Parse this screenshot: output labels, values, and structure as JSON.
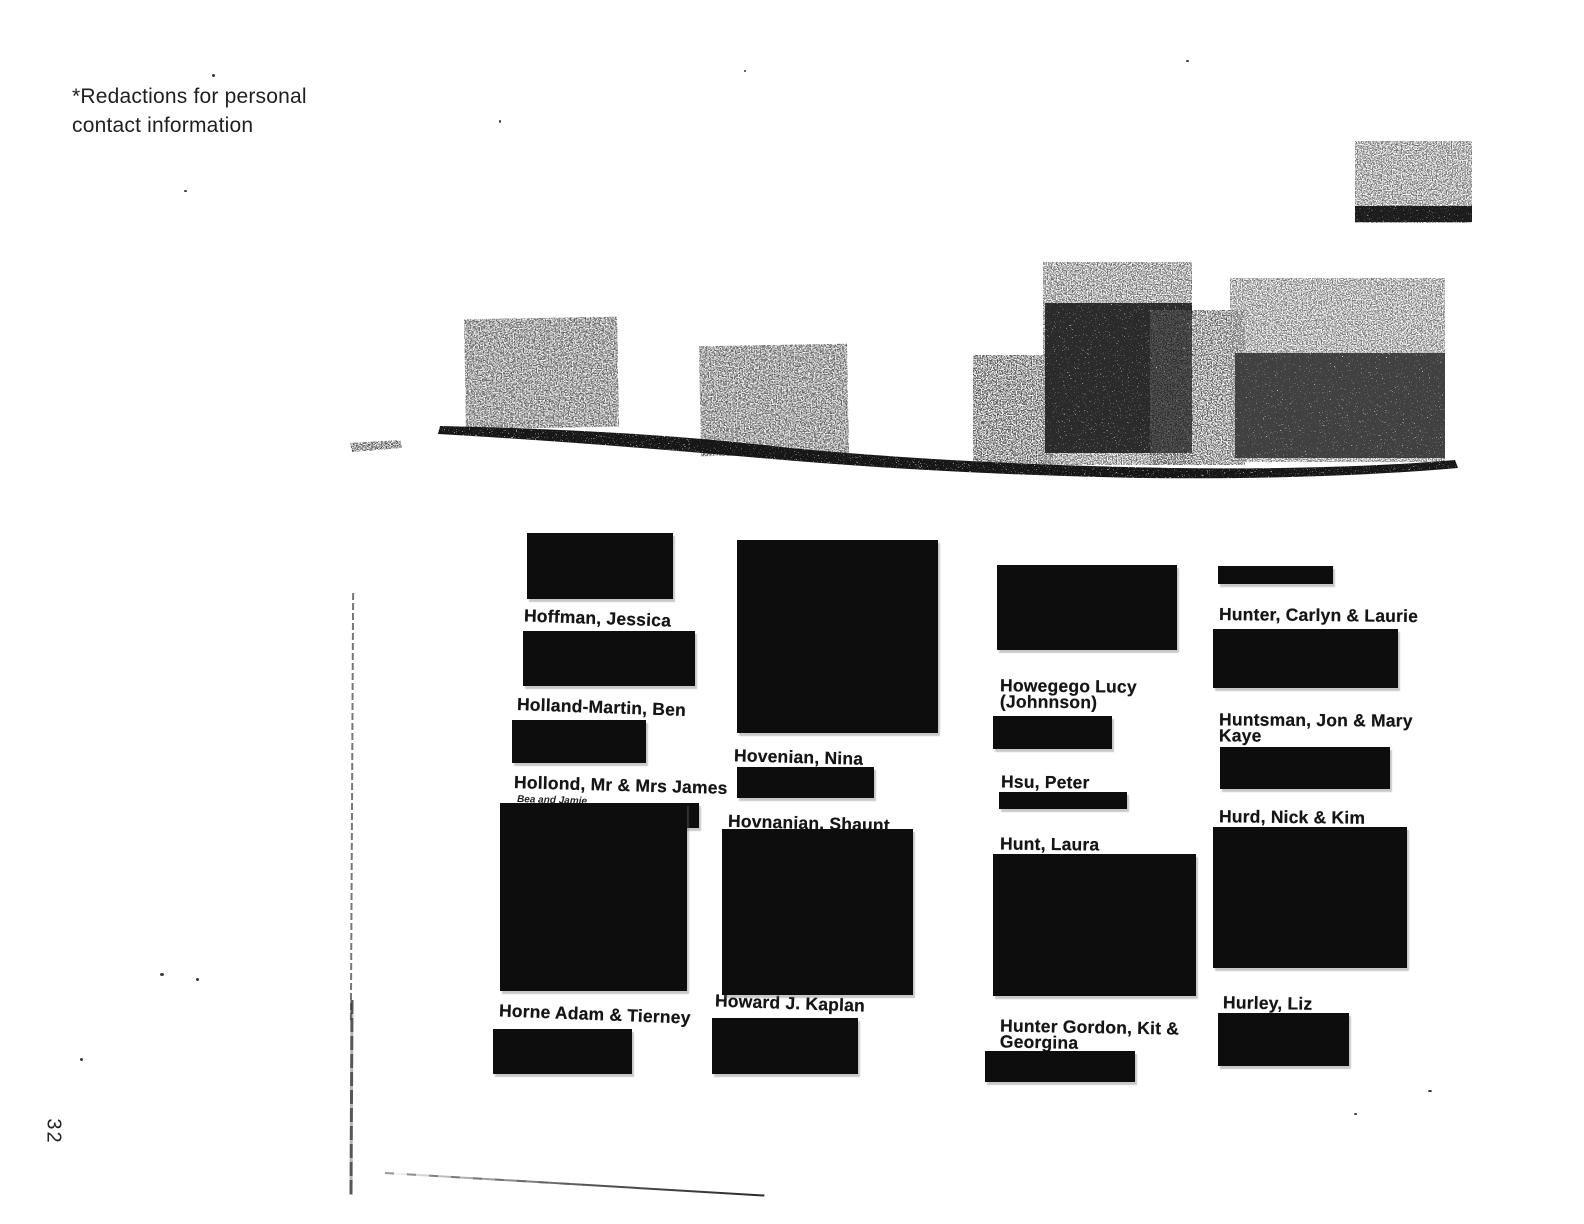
{
  "note": "*Redactions for personal\ncontact information",
  "page_number": "32",
  "entries": [
    {
      "name": "Hoffman, Jessica"
    },
    {
      "name": "Holland-Martin, Ben"
    },
    {
      "name": "Hollond, Mr & Mrs James",
      "sub": "Bea and Jamie"
    },
    {
      "name": "Horne Adam & Tierney"
    },
    {
      "name": "Hovenian, Nina"
    },
    {
      "name": "Hovnanian, Shaunt"
    },
    {
      "name": "Howard J. Kaplan"
    },
    {
      "name": "Howegego Lucy\n(Johnnson)"
    },
    {
      "name": "Hsu, Peter"
    },
    {
      "name": "Hunt, Laura"
    },
    {
      "name": "Hunter Gordon, Kit &\nGeorgina"
    },
    {
      "name": "Hunter, Carlyn & Laurie"
    },
    {
      "name": "Huntsman, Jon & Mary\nKaye"
    },
    {
      "name": "Hurd, Nick & Kim"
    },
    {
      "name": "Hurley, Liz"
    }
  ]
}
